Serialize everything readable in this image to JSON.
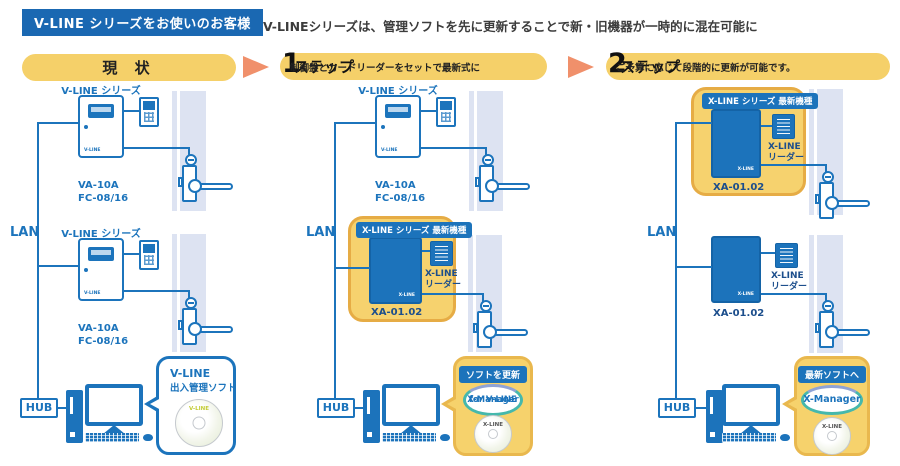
{
  "header": {
    "tag": "V-LINE シリーズをお使いのお客様",
    "description": "V-LINEシリーズは、管理ソフトを先に更新することで新・旧機器が一時的に混在可能に"
  },
  "stages": {
    "current": {
      "title": "現 状"
    },
    "step1": {
      "prefix": "ステップ",
      "number": "1",
      "note": "制御盤とカードリーダーをセットで最新式に"
    },
    "step2": {
      "prefix": "ステップ",
      "number": "2",
      "note": "ご予算に応じて段階的に更新が可能です。"
    }
  },
  "network": {
    "lan_label": "LAN",
    "hub_label": "HUB"
  },
  "devices": {
    "vline": {
      "series_label": "V-LINE シリーズ",
      "model_line1": "VA-10A",
      "model_line2": "FC-08/16",
      "panel_logo": "V-LINE"
    },
    "xline": {
      "highlight_label": "X-LINE シリーズ 最新機種",
      "model": "XA-01.02",
      "reader_line1": "X-LINE",
      "reader_line2": "リーダー",
      "panel_logo": "X-LINE"
    }
  },
  "bubbles": {
    "current": {
      "title": "V-LINE",
      "subtitle": "出入管理ソフト",
      "cd_label": "V-LINE"
    },
    "step1": {
      "badge": "ソフトを更新",
      "app_line1": "X-Manager",
      "app_line2": "for V-LINE",
      "cd_label": "X-LINE"
    },
    "step2": {
      "badge": "最新ソフトへ",
      "app_line1": "X-Manager",
      "cd_label": "X-LINE"
    }
  },
  "colors": {
    "brand_blue": "#1c74bc",
    "header_bg": "#1a68b2",
    "highlight_yellow": "#f6d26e",
    "highlight_border": "#e6ac45",
    "pill_yellow": "#f5d069",
    "arrow_orange": "#f0906b",
    "wall": "#dde3f2",
    "teal_ring": "#45b8ac"
  }
}
